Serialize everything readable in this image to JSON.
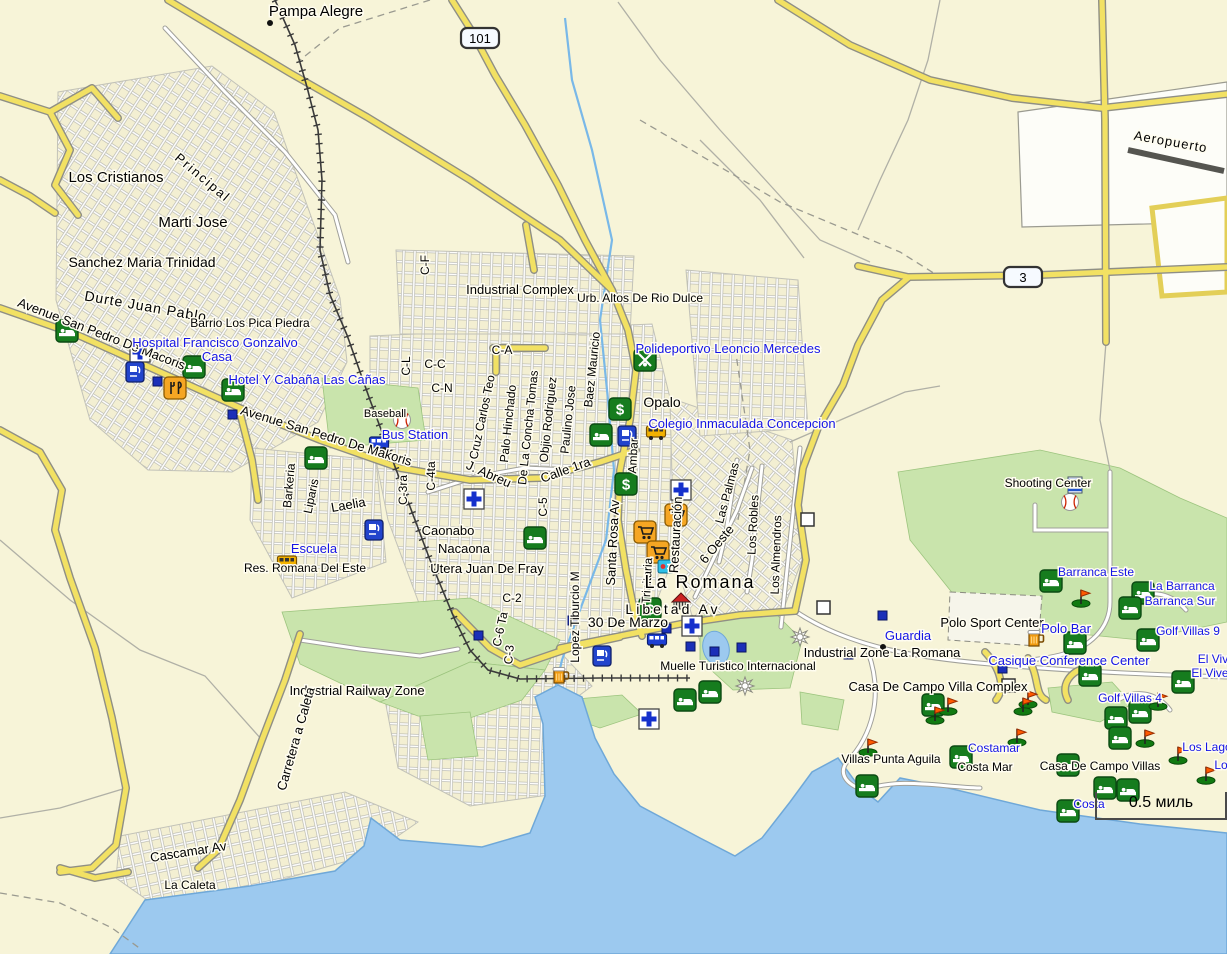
{
  "map": {
    "colors": {
      "land": "#f7f4d8",
      "water": "#9cc9ef",
      "water_edge": "#6fa8d8",
      "green": "#c9e4ac",
      "green_edge": "#9cc47e",
      "road_yellow": "#f2e163",
      "road_casing": "#8f8f85",
      "road_white": "#ffffff",
      "white_casing": "#a0a09a",
      "rail": "#3a3a3a",
      "label_black": "#000000",
      "label_blue": "#1414e6",
      "halo": "#fffdf0",
      "runway": "#555550"
    },
    "scale_bar": {
      "label": "0.5 миль"
    },
    "shields": [
      {
        "text": "101",
        "x": 480,
        "y": 38
      },
      {
        "text": "3",
        "x": 1023,
        "y": 277
      }
    ],
    "city_dots": [
      {
        "x": 270,
        "y": 23
      },
      {
        "x": 883,
        "y": 647
      }
    ],
    "labels": [
      {
        "text": "Pampa Alegre",
        "x": 316,
        "y": 16,
        "rot": 0,
        "size": 15,
        "color": "k"
      },
      {
        "text": "Los Cristianos",
        "x": 116,
        "y": 182,
        "rot": 0,
        "size": 15,
        "color": "k"
      },
      {
        "text": "Principal",
        "x": 200,
        "y": 181,
        "rot": 40,
        "size": 13,
        "color": "k",
        "ls": 2
      },
      {
        "text": "Marti Jose",
        "x": 193,
        "y": 227,
        "rot": 0,
        "size": 15,
        "color": "k"
      },
      {
        "text": "Sanchez Maria Trinidad",
        "x": 142,
        "y": 267,
        "rot": 0,
        "size": 14,
        "color": "k"
      },
      {
        "text": "Durte Juan Pablo",
        "x": 145,
        "y": 311,
        "rot": 10,
        "size": 14,
        "color": "k",
        "ls": 1
      },
      {
        "text": "Barrio Los Pica Piedra",
        "x": 250,
        "y": 327,
        "rot": 0,
        "size": 12,
        "color": "k"
      },
      {
        "text": "Avenue San Pedro De Macoris",
        "x": 100,
        "y": 338,
        "rot": 21,
        "size": 13,
        "color": "k"
      },
      {
        "text": "Avenue San Pedro De Makoris",
        "x": 325,
        "y": 440,
        "rot": 17,
        "size": 13,
        "color": "k"
      },
      {
        "text": "Baseball",
        "x": 385,
        "y": 417,
        "rot": 0,
        "size": 11,
        "color": "k"
      },
      {
        "text": "Barkeria",
        "x": 293,
        "y": 486,
        "rot": -85,
        "size": 12,
        "color": "k"
      },
      {
        "text": "Liparis",
        "x": 315,
        "y": 497,
        "rot": -78,
        "size": 12,
        "color": "k"
      },
      {
        "text": "Laelia",
        "x": 349,
        "y": 509,
        "rot": -10,
        "size": 13,
        "color": "k"
      },
      {
        "text": "C-3ra",
        "x": 407,
        "y": 490,
        "rot": -90,
        "size": 12,
        "color": "k"
      },
      {
        "text": "C-4ta",
        "x": 435,
        "y": 476,
        "rot": -90,
        "size": 12,
        "color": "k"
      },
      {
        "text": "Caonabo",
        "x": 448,
        "y": 535,
        "rot": 0,
        "size": 13,
        "color": "k"
      },
      {
        "text": "Nacaona",
        "x": 464,
        "y": 553,
        "rot": 0,
        "size": 13,
        "color": "k"
      },
      {
        "text": "Utera Juan De Fray",
        "x": 487,
        "y": 573,
        "rot": 0,
        "size": 13,
        "color": "k"
      },
      {
        "text": "C-2",
        "x": 512,
        "y": 602,
        "rot": 0,
        "size": 12,
        "color": "k"
      },
      {
        "text": "C-6 Ta",
        "x": 504,
        "y": 630,
        "rot": -78,
        "size": 12,
        "color": "k"
      },
      {
        "text": "C-3",
        "x": 513,
        "y": 655,
        "rot": -85,
        "size": 12,
        "color": "k"
      },
      {
        "text": "C-5",
        "x": 547,
        "y": 507,
        "rot": -90,
        "size": 12,
        "color": "k"
      },
      {
        "text": "Lopez Tiburcio M",
        "x": 579,
        "y": 617,
        "rot": -90,
        "size": 12,
        "color": "k"
      },
      {
        "text": "30 De Marzo",
        "x": 628,
        "y": 627,
        "rot": 0,
        "size": 14,
        "color": "k"
      },
      {
        "text": "Santa Rosa Av",
        "x": 617,
        "y": 543,
        "rot": -87,
        "size": 13,
        "color": "k"
      },
      {
        "text": "Restauración",
        "x": 680,
        "y": 535,
        "rot": -87,
        "size": 13,
        "color": "k"
      },
      {
        "text": "Trinitaria",
        "x": 651,
        "y": 581,
        "rot": -87,
        "size": 12,
        "color": "k"
      },
      {
        "text": "Ambar",
        "x": 637,
        "y": 456,
        "rot": -87,
        "size": 12,
        "color": "k"
      },
      {
        "text": "Opalo",
        "x": 662,
        "y": 407,
        "rot": 0,
        "size": 14,
        "color": "k"
      },
      {
        "text": "Baez Mauricio",
        "x": 596,
        "y": 370,
        "rot": -84,
        "size": 12,
        "color": "k"
      },
      {
        "text": "Paulino Jose",
        "x": 572,
        "y": 420,
        "rot": -84,
        "size": 12,
        "color": "k"
      },
      {
        "text": "Objio Rodriguez",
        "x": 552,
        "y": 420,
        "rot": -84,
        "size": 12,
        "color": "k"
      },
      {
        "text": "De La Concha Tomas",
        "x": 532,
        "y": 428,
        "rot": -84,
        "size": 12,
        "color": "k"
      },
      {
        "text": "Palo Hinchado",
        "x": 512,
        "y": 424,
        "rot": -84,
        "size": 12,
        "color": "k"
      },
      {
        "text": "Cruz Carlos Teo",
        "x": 486,
        "y": 418,
        "rot": -78,
        "size": 12,
        "color": "k"
      },
      {
        "text": "J. Abreu",
        "x": 487,
        "y": 478,
        "rot": 24,
        "size": 13,
        "color": "k"
      },
      {
        "text": "Calle 1ra",
        "x": 567,
        "y": 474,
        "rot": -20,
        "size": 13,
        "color": "k"
      },
      {
        "text": "6 Oeste",
        "x": 720,
        "y": 547,
        "rot": -50,
        "size": 13,
        "color": "k"
      },
      {
        "text": "Las Palmas",
        "x": 731,
        "y": 494,
        "rot": -75,
        "size": 12,
        "color": "k"
      },
      {
        "text": "Los Robles",
        "x": 757,
        "y": 525,
        "rot": -87,
        "size": 12,
        "color": "k"
      },
      {
        "text": "Los Almendros",
        "x": 780,
        "y": 555,
        "rot": -88,
        "size": 12,
        "color": "k"
      },
      {
        "text": "Res. Romana Del Este",
        "x": 305,
        "y": 572,
        "rot": 0,
        "size": 12,
        "color": "k"
      },
      {
        "text": "C-F",
        "x": 429,
        "y": 265,
        "rot": -90,
        "size": 12,
        "color": "k"
      },
      {
        "text": "C-A",
        "x": 502,
        "y": 354,
        "rot": 0,
        "size": 12,
        "color": "k"
      },
      {
        "text": "C-L",
        "x": 410,
        "y": 366,
        "rot": -90,
        "size": 12,
        "color": "k"
      },
      {
        "text": "C-C",
        "x": 435,
        "y": 368,
        "rot": 0,
        "size": 12,
        "color": "k"
      },
      {
        "text": "C-N",
        "x": 442,
        "y": 392,
        "rot": 0,
        "size": 12,
        "color": "k"
      },
      {
        "text": "Industrial Complex",
        "x": 520,
        "y": 294,
        "rot": 0,
        "size": 13,
        "color": "k"
      },
      {
        "text": "Urb. Altos De Rio Dulce",
        "x": 640,
        "y": 302,
        "rot": 0,
        "size": 12,
        "color": "k"
      },
      {
        "text": "Industrial Railway Zone",
        "x": 357,
        "y": 695,
        "rot": 0,
        "size": 13,
        "color": "k"
      },
      {
        "text": "Carretera a Caleta",
        "x": 300,
        "y": 740,
        "rot": -74,
        "size": 13,
        "color": "k"
      },
      {
        "text": "La Romana",
        "x": 700,
        "y": 588,
        "rot": 0,
        "size": 18,
        "color": "k",
        "ls": 2
      },
      {
        "text": "Libetad Av",
        "x": 673,
        "y": 614,
        "rot": 0,
        "size": 14,
        "color": "k",
        "ls": 3
      },
      {
        "text": "Muelle Turistico Internacional",
        "x": 738,
        "y": 670,
        "rot": 0,
        "size": 12,
        "color": "k"
      },
      {
        "text": "Industrial Zone La Romana",
        "x": 882,
        "y": 657,
        "rot": 0,
        "size": 13,
        "color": "k"
      },
      {
        "text": "Polo Sport Center",
        "x": 992,
        "y": 627,
        "rot": 0,
        "size": 13,
        "color": "k"
      },
      {
        "text": "Casa De Campo Villa Complex",
        "x": 938,
        "y": 691,
        "rot": 0,
        "size": 13,
        "color": "k"
      },
      {
        "text": "Villas Punta Aguila",
        "x": 891,
        "y": 763,
        "rot": 0,
        "size": 12,
        "color": "k"
      },
      {
        "text": "Costa Mar",
        "x": 985,
        "y": 771,
        "rot": 0,
        "size": 12,
        "color": "k"
      },
      {
        "text": "Casa De Campo Villas",
        "x": 1100,
        "y": 770,
        "rot": 0,
        "size": 12,
        "color": "k"
      },
      {
        "text": "Shooting Center",
        "x": 1048,
        "y": 487,
        "rot": 0,
        "size": 12,
        "color": "k"
      },
      {
        "text": "Aeropuerto",
        "x": 1170,
        "y": 146,
        "rot": 10,
        "size": 13,
        "color": "k",
        "ls": 1
      },
      {
        "text": "Cascamar Av",
        "x": 189,
        "y": 856,
        "rot": -9,
        "size": 13,
        "color": "k"
      },
      {
        "text": "La Caleta",
        "x": 190,
        "y": 889,
        "rot": 0,
        "size": 12,
        "color": "k"
      },
      {
        "text": "Hospital Francisco Gonzalvo",
        "x": 215,
        "y": 347,
        "rot": 0,
        "size": 13,
        "color": "b"
      },
      {
        "text": "Casa",
        "x": 217,
        "y": 361,
        "rot": 0,
        "size": 13,
        "color": "b"
      },
      {
        "text": "Hotel Y Cabaña Las Cañas",
        "x": 307,
        "y": 384,
        "rot": 0,
        "size": 13,
        "color": "b"
      },
      {
        "text": "Bus Station",
        "x": 415,
        "y": 439,
        "rot": 0,
        "size": 13,
        "color": "b"
      },
      {
        "text": "Escuela",
        "x": 314,
        "y": 553,
        "rot": 0,
        "size": 13,
        "color": "b"
      },
      {
        "text": "Polideportivo Leoncio Mercedes",
        "x": 728,
        "y": 353,
        "rot": 0,
        "size": 13,
        "color": "b"
      },
      {
        "text": "Colegio Inmaculada Concepcion",
        "x": 742,
        "y": 428,
        "rot": 0,
        "size": 13,
        "color": "b"
      },
      {
        "text": "Guardia",
        "x": 908,
        "y": 640,
        "rot": 0,
        "size": 13,
        "color": "b"
      },
      {
        "text": "Polo Bar",
        "x": 1066,
        "y": 633,
        "rot": 0,
        "size": 13,
        "color": "b"
      },
      {
        "text": "Casique Conference Center",
        "x": 1069,
        "y": 665,
        "rot": 0,
        "size": 13,
        "color": "b"
      },
      {
        "text": "Barranca Este",
        "x": 1096,
        "y": 576,
        "rot": 0,
        "size": 12,
        "color": "b"
      },
      {
        "text": "La Barranca",
        "x": 1182,
        "y": 590,
        "rot": 0,
        "size": 12,
        "color": "b"
      },
      {
        "text": "Barranca Sur",
        "x": 1180,
        "y": 605,
        "rot": 0,
        "size": 12,
        "color": "b"
      },
      {
        "text": "Golf Villas 9",
        "x": 1188,
        "y": 635,
        "rot": 0,
        "size": 12,
        "color": "b"
      },
      {
        "text": "El Viv",
        "x": 1213,
        "y": 663,
        "rot": 0,
        "size": 12,
        "color": "b"
      },
      {
        "text": "El Vive",
        "x": 1210,
        "y": 677,
        "rot": 0,
        "size": 12,
        "color": "b"
      },
      {
        "text": "Golf Villas 4",
        "x": 1130,
        "y": 702,
        "rot": 0,
        "size": 12,
        "color": "b"
      },
      {
        "text": "Los Lago",
        "x": 1207,
        "y": 751,
        "rot": 0,
        "size": 12,
        "color": "b"
      },
      {
        "text": "Lo",
        "x": 1221,
        "y": 769,
        "rot": 0,
        "size": 12,
        "color": "b"
      },
      {
        "text": "Costamar",
        "x": 994,
        "y": 752,
        "rot": 0,
        "size": 12,
        "color": "b"
      },
      {
        "text": "Costa",
        "x": 1089,
        "y": 808,
        "rot": 0,
        "size": 12,
        "color": "b"
      }
    ],
    "pois": [
      {
        "type": "lodging",
        "x": 67,
        "y": 331
      },
      {
        "type": "lodging",
        "x": 194,
        "y": 367
      },
      {
        "type": "lodging",
        "x": 233,
        "y": 390
      },
      {
        "type": "lodging",
        "x": 316,
        "y": 458
      },
      {
        "type": "lodging",
        "x": 601,
        "y": 435
      },
      {
        "type": "lodging",
        "x": 535,
        "y": 538
      },
      {
        "type": "lodging",
        "x": 685,
        "y": 700
      },
      {
        "type": "lodging",
        "x": 710,
        "y": 692
      },
      {
        "type": "lodging",
        "x": 1051,
        "y": 581
      },
      {
        "type": "lodging",
        "x": 1143,
        "y": 593
      },
      {
        "type": "lodging",
        "x": 1130,
        "y": 608
      },
      {
        "type": "lodging",
        "x": 1148,
        "y": 640
      },
      {
        "type": "lodging",
        "x": 1075,
        "y": 643
      },
      {
        "type": "lodging",
        "x": 1090,
        "y": 675
      },
      {
        "type": "lodging",
        "x": 1183,
        "y": 682
      },
      {
        "type": "lodging",
        "x": 933,
        "y": 705
      },
      {
        "type": "lodging",
        "x": 1116,
        "y": 718
      },
      {
        "type": "lodging",
        "x": 1140,
        "y": 712
      },
      {
        "type": "lodging",
        "x": 1120,
        "y": 738
      },
      {
        "type": "lodging",
        "x": 961,
        "y": 757
      },
      {
        "type": "lodging",
        "x": 867,
        "y": 786
      },
      {
        "type": "lodging",
        "x": 1068,
        "y": 765
      },
      {
        "type": "lodging",
        "x": 1105,
        "y": 788
      },
      {
        "type": "lodging",
        "x": 1128,
        "y": 790
      },
      {
        "type": "lodging",
        "x": 1068,
        "y": 811
      },
      {
        "type": "bank",
        "x": 620,
        "y": 409
      },
      {
        "type": "bank",
        "x": 626,
        "y": 484
      },
      {
        "type": "bank",
        "x": 650,
        "y": 609
      },
      {
        "type": "first-aid",
        "x": 140,
        "y": 352
      },
      {
        "type": "first-aid",
        "x": 474,
        "y": 499
      },
      {
        "type": "first-aid",
        "x": 681,
        "y": 490
      },
      {
        "type": "first-aid",
        "x": 692,
        "y": 626
      },
      {
        "type": "first-aid",
        "x": 649,
        "y": 719
      },
      {
        "type": "fuel",
        "x": 135,
        "y": 372
      },
      {
        "type": "fuel",
        "x": 374,
        "y": 530
      },
      {
        "type": "fuel",
        "x": 602,
        "y": 656
      },
      {
        "type": "fuel",
        "x": 627,
        "y": 436
      },
      {
        "type": "restaurant",
        "x": 175,
        "y": 388
      },
      {
        "type": "shopping",
        "x": 676,
        "y": 515
      },
      {
        "type": "shopping",
        "x": 645,
        "y": 532
      },
      {
        "type": "shopping",
        "x": 658,
        "y": 552
      },
      {
        "type": "bar",
        "x": 560,
        "y": 676
      },
      {
        "type": "bar",
        "x": 1035,
        "y": 639
      },
      {
        "type": "bus",
        "x": 379,
        "y": 443
      },
      {
        "type": "bus",
        "x": 657,
        "y": 640
      },
      {
        "type": "school-bus",
        "x": 287,
        "y": 562
      },
      {
        "type": "school-bus",
        "x": 656,
        "y": 432
      },
      {
        "type": "sports",
        "x": 645,
        "y": 360
      },
      {
        "type": "baseball",
        "x": 402,
        "y": 420
      },
      {
        "type": "baseball",
        "x": 1070,
        "y": 502
      },
      {
        "type": "striped-flag",
        "x": 1075,
        "y": 485
      },
      {
        "type": "landmark",
        "x": 681,
        "y": 601
      },
      {
        "type": "marina",
        "x": 800,
        "y": 637
      },
      {
        "type": "marina",
        "x": 745,
        "y": 686
      },
      {
        "type": "poi-square",
        "x": 157,
        "y": 381
      },
      {
        "type": "poi-square",
        "x": 232,
        "y": 414
      },
      {
        "type": "poi-square",
        "x": 666,
        "y": 628
      },
      {
        "type": "poi-square",
        "x": 690,
        "y": 646
      },
      {
        "type": "poi-square",
        "x": 714,
        "y": 651
      },
      {
        "type": "poi-square",
        "x": 741,
        "y": 647
      },
      {
        "type": "poi-square",
        "x": 848,
        "y": 654
      },
      {
        "type": "poi-square",
        "x": 882,
        "y": 615
      },
      {
        "type": "poi-square",
        "x": 1002,
        "y": 668
      },
      {
        "type": "poi-square",
        "x": 572,
        "y": 620
      },
      {
        "type": "poi-square",
        "x": 478,
        "y": 635
      },
      {
        "type": "info",
        "x": 666,
        "y": 566
      },
      {
        "type": "junction-box",
        "x": 824,
        "y": 608
      },
      {
        "type": "junction-box",
        "x": 1009,
        "y": 686
      },
      {
        "type": "junction-box",
        "x": 808,
        "y": 520
      },
      {
        "type": "golf-flag",
        "x": 1081,
        "y": 597
      },
      {
        "type": "golf-flag",
        "x": 1028,
        "y": 698
      },
      {
        "type": "golf-flag",
        "x": 948,
        "y": 705
      },
      {
        "type": "golf-flag",
        "x": 1023,
        "y": 705
      },
      {
        "type": "golf-flag",
        "x": 935,
        "y": 714
      },
      {
        "type": "golf-flag",
        "x": 868,
        "y": 746
      },
      {
        "type": "golf-flag",
        "x": 1017,
        "y": 736
      },
      {
        "type": "golf-flag",
        "x": 1145,
        "y": 737
      },
      {
        "type": "golf-flag",
        "x": 1178,
        "y": 754
      },
      {
        "type": "golf-flag",
        "x": 1206,
        "y": 774
      },
      {
        "type": "golf-flag",
        "x": 1158,
        "y": 700
      }
    ]
  }
}
